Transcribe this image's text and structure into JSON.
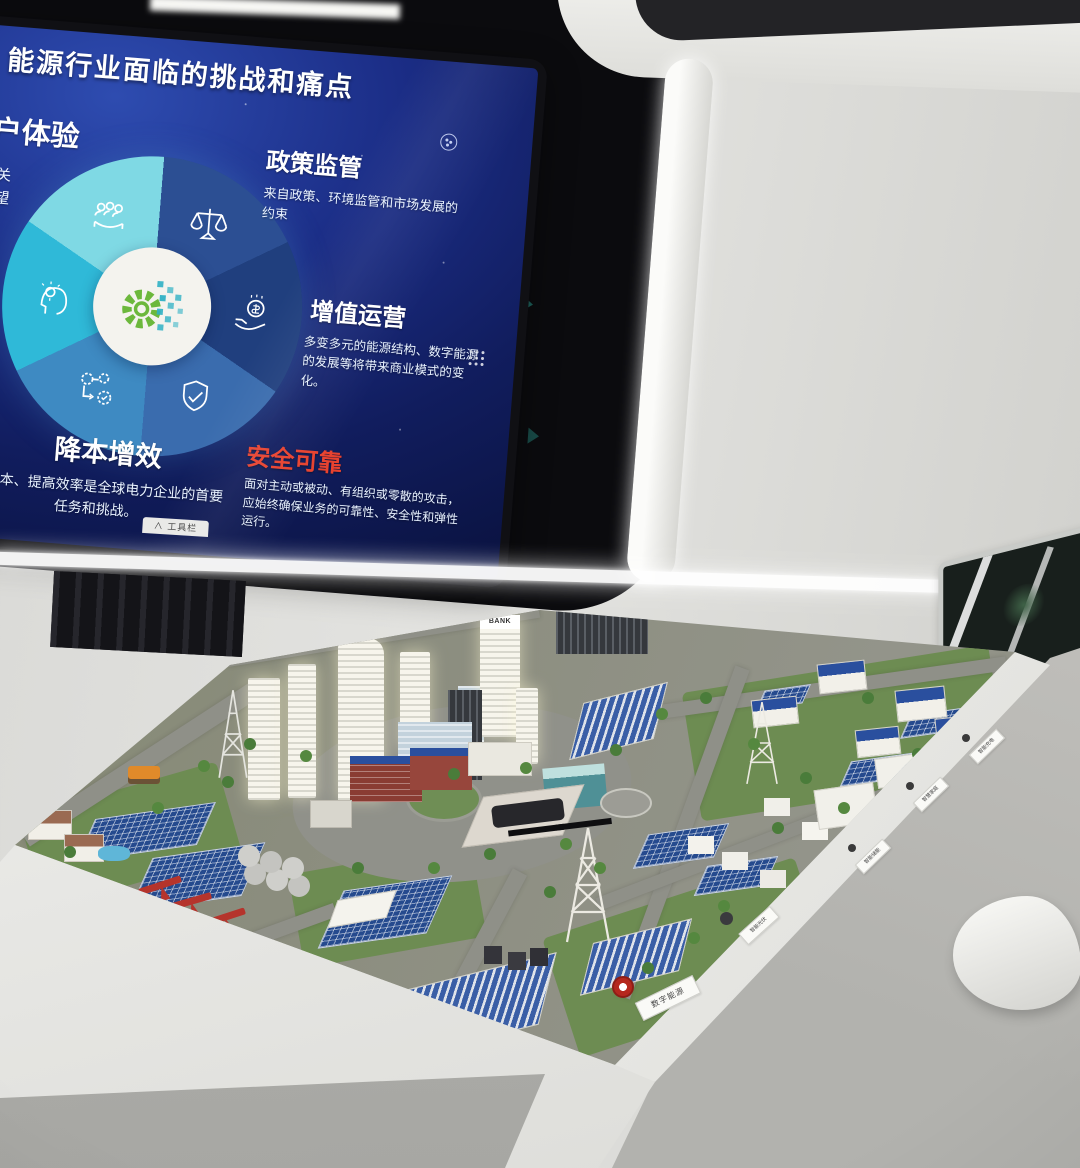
{
  "screen": {
    "title": "能源行业面临的挑战和痛点",
    "toolbar_caret": "∧",
    "toolbar_tab": "工具栏",
    "sections": {
      "customer": {
        "heading": "客户体验",
        "lines": [
          "者之间的关",
          "合客户期望",
          "力的关键。"
        ]
      },
      "policy": {
        "heading": "政策监管",
        "body": "来自政策、环境监管和市场发展的约束"
      },
      "value": {
        "heading": "增值运营",
        "body": "多变多元的能源结构、数字能源的发展等将带来商业模式的变化。"
      },
      "transform": {
        "heading": "变革",
        "lines": [
          "学等方",
          "，培养",
          "化能力。"
        ]
      },
      "cost": {
        "heading": "降本增效",
        "body": "的成本、提高效率是全球电力企业的首要任务和挑战。"
      },
      "security": {
        "heading": "安全可靠",
        "body": "面对主动或被动、有组织或零散的攻击，应始终确保业务的可靠性、安全性和弹性运行。"
      }
    },
    "icons": [
      "people-service-icon",
      "scales-icon",
      "coin-hand-icon",
      "shield-check-icon",
      "gears-flow-icon",
      "head-bulb-icon",
      "gear-pixel-icon"
    ],
    "colors": {
      "slide_bg": "#1b2d86",
      "security_red": "#e8422f",
      "gear_green": "#6cb83c",
      "pixel_teal": "#2fb9c9",
      "ring_segments": [
        "#2c4f93",
        "#203f7e",
        "#3a6cae",
        "#3e8ac2",
        "#2fb9d8",
        "#7fd9e4"
      ]
    }
  },
  "model": {
    "bank_sign": "BANK",
    "front_label": "数字能源",
    "edge_labels": [
      "智能充电",
      "智慧家庭",
      "智能储能",
      "智能光伏"
    ]
  }
}
